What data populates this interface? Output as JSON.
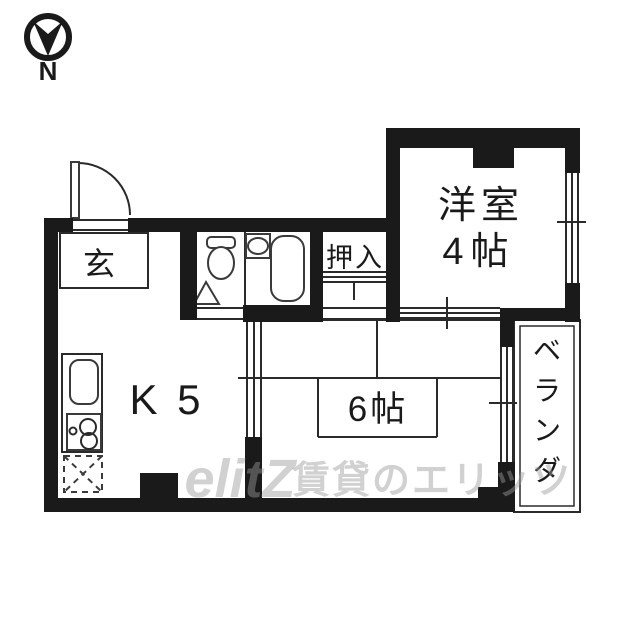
{
  "compass": {
    "label": "N",
    "direction": "arrow-points-down"
  },
  "rooms": {
    "entrance": {
      "label": "玄"
    },
    "kitchen": {
      "label": "K 5"
    },
    "tatami_room": {
      "label": "6帖"
    },
    "western_room": {
      "name": "洋室",
      "size": "4帖"
    },
    "closet": {
      "label": "押入"
    },
    "veranda": {
      "label": "ベランダ",
      "chars": [
        "ベ",
        "ラ",
        "ン",
        "ダ"
      ]
    }
  },
  "icons": [
    "compass-north-icon",
    "entrance-door-icon",
    "toilet-icon",
    "toilet-door-triangle-icon",
    "washbasin-icon",
    "bathtub-icon",
    "kitchen-sink-icon",
    "stove-burners-icon",
    "refrigerator-space-icon"
  ],
  "watermark": {
    "logo": "elitZ",
    "text": "賃貸のエリッツ"
  },
  "colors": {
    "wall": "#1a1a1a",
    "line": "#2a2a2a",
    "background": "#ffffff",
    "watermark": "#9a9a9a"
  }
}
